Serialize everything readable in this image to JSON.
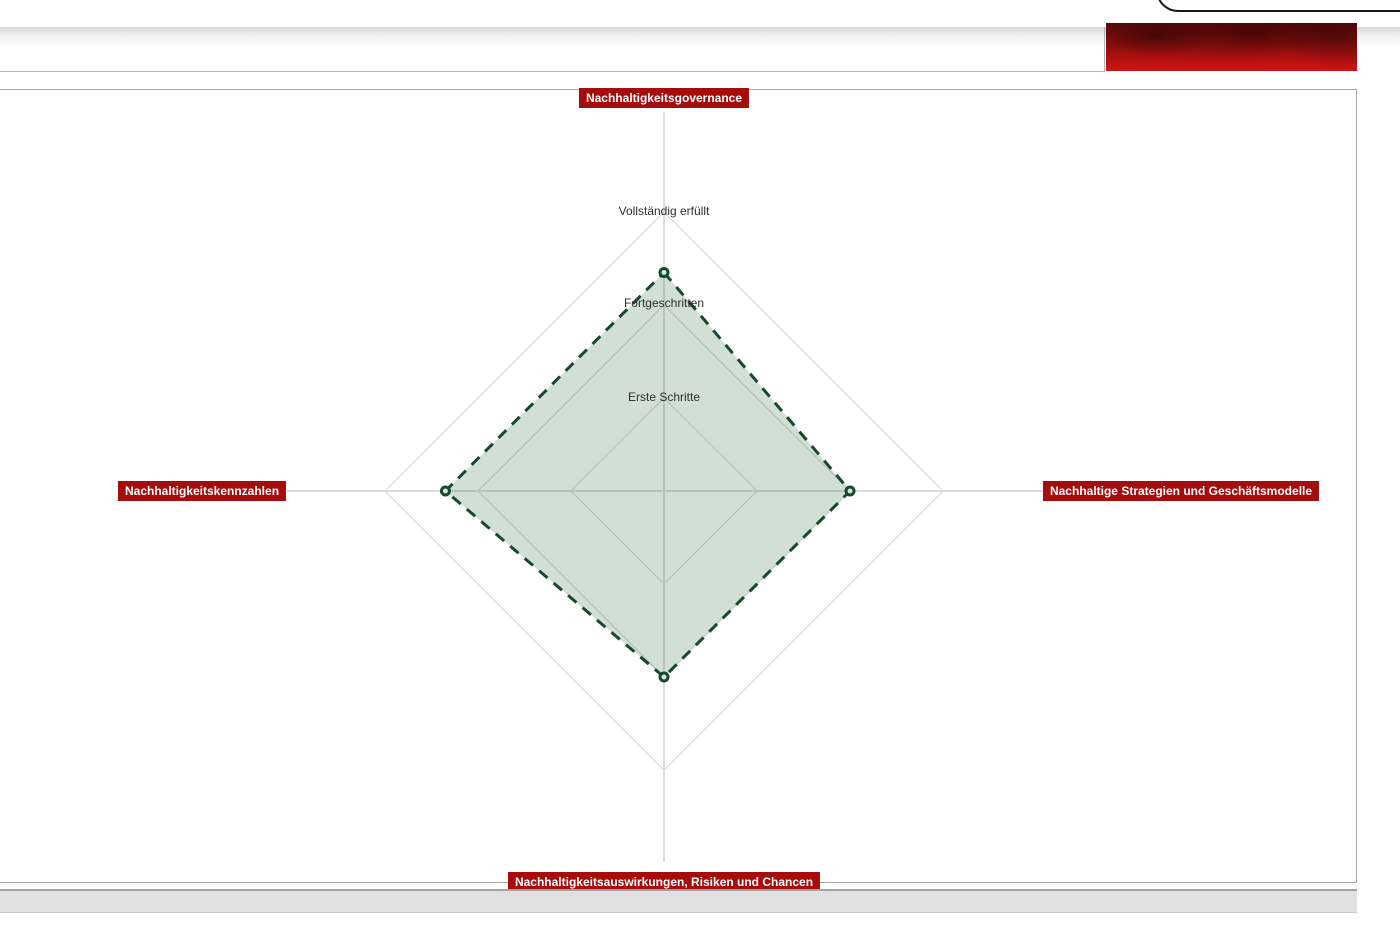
{
  "chart_data": {
    "type": "radar",
    "title": "",
    "axes": [
      "Nachhaltigkeitsgovernance",
      "Nachhaltige Strategien und Geschäftsmodelle",
      "Nachhaltigkeitsauswirkungen, Risiken und Chancen",
      "Nachhaltigkeitskennzahlen"
    ],
    "axes_order": "top, right, bottom, left",
    "values": [
      2.35,
      2.0,
      2.0,
      2.35
    ],
    "ring_labels": [
      "Erste Schritte",
      "Fortgeschritten",
      "Vollständig erfüllt"
    ],
    "scale": {
      "min": 0,
      "max": 3,
      "rings": 3
    },
    "grid": "diamond (square) concentric rings, light gray, labels on upper vertical axis",
    "legend": "none",
    "series_line_style": "dashed",
    "colors": {
      "series_stroke": "#17492e",
      "series_fill": "rgba(44,110,66,0.22)",
      "marker_fill": "#d4e8da",
      "axis_badge_bg": "#a50d0d",
      "axis_badge_text": "#ffffff",
      "gridline": "#d9d9d9"
    }
  },
  "theme": {
    "badge_red": "#a50d0d",
    "banner_red_dark": "#5e0909",
    "banner_red_bright": "#cf1414",
    "panel_border": "#a9a9a9",
    "scrollbar_gray": "#e1e1e1",
    "logo_corner_black": "#161616"
  }
}
